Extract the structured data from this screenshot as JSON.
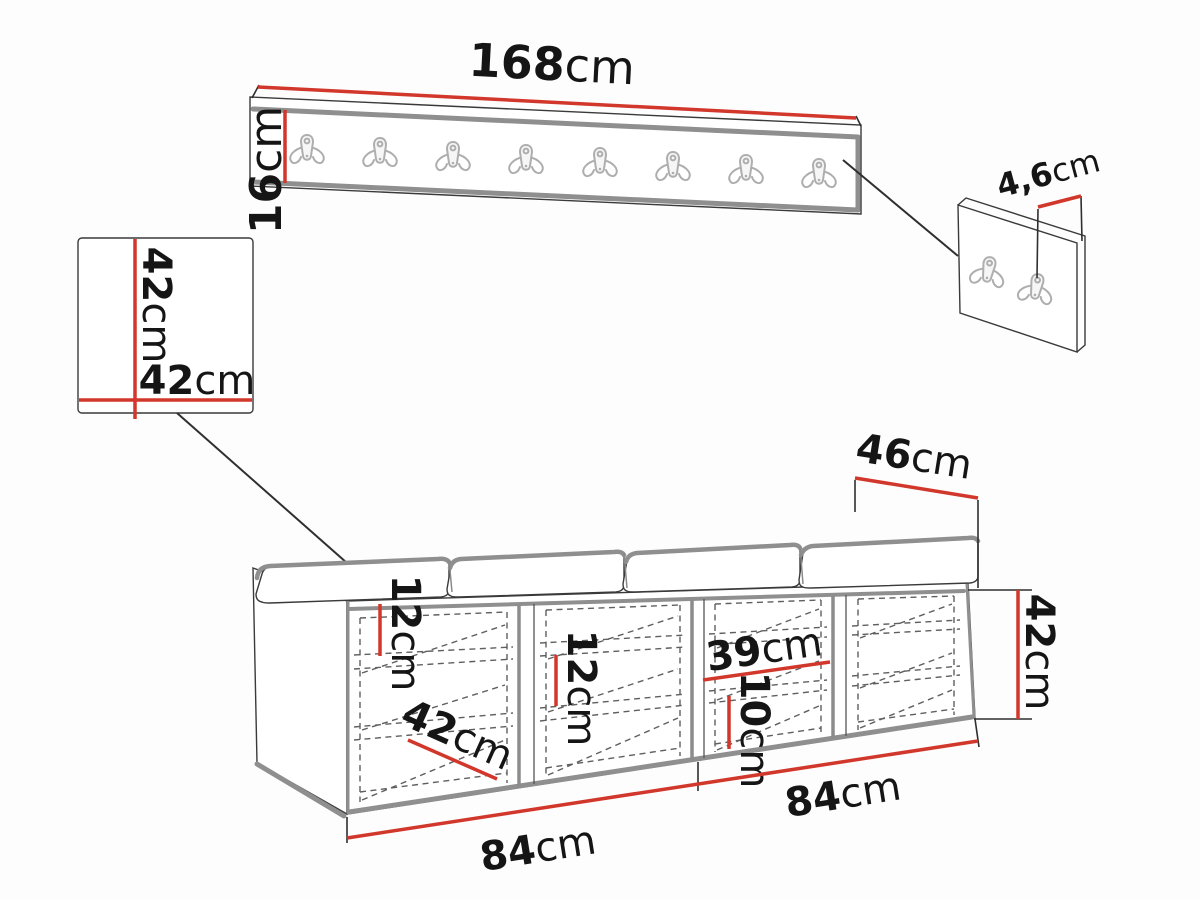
{
  "diagram_type": "furniture dimension drawing",
  "colors": {
    "dimension_red": "#d2372b",
    "outline_gray": "#8f8f8f",
    "hook_gray": "#aeaeae",
    "line_black": "#2f2f2f",
    "background": "#fdfdfd"
  },
  "coat_rack": {
    "hook_count": 8,
    "width_label": {
      "value": "168",
      "unit": "cm"
    },
    "height_label": {
      "value": "16",
      "unit": "cm"
    }
  },
  "square_panel": {
    "height_label": {
      "value": "42",
      "unit": "cm"
    },
    "width_label": {
      "value": "42",
      "unit": "cm"
    }
  },
  "hook_panel": {
    "hook_count": 2,
    "depth_label": {
      "value": "4,6",
      "unit": "cm"
    }
  },
  "bench": {
    "compartment_count": 4,
    "depth_label": {
      "value": "46",
      "unit": "cm"
    },
    "height_label": {
      "value": "42",
      "unit": "cm"
    },
    "shelf_gap_top_label": {
      "value": "12",
      "unit": "cm"
    },
    "shelf_gap_middle_label": {
      "value": "12",
      "unit": "cm"
    },
    "compartment_width_label": {
      "value": "39",
      "unit": "cm"
    },
    "bottom_gap_label": {
      "value": "10",
      "unit": "cm"
    },
    "shelf_depth_label": {
      "value": "42",
      "unit": "cm"
    },
    "width_left_label": {
      "value": "84",
      "unit": "cm"
    },
    "width_right_label": {
      "value": "84",
      "unit": "cm"
    }
  }
}
